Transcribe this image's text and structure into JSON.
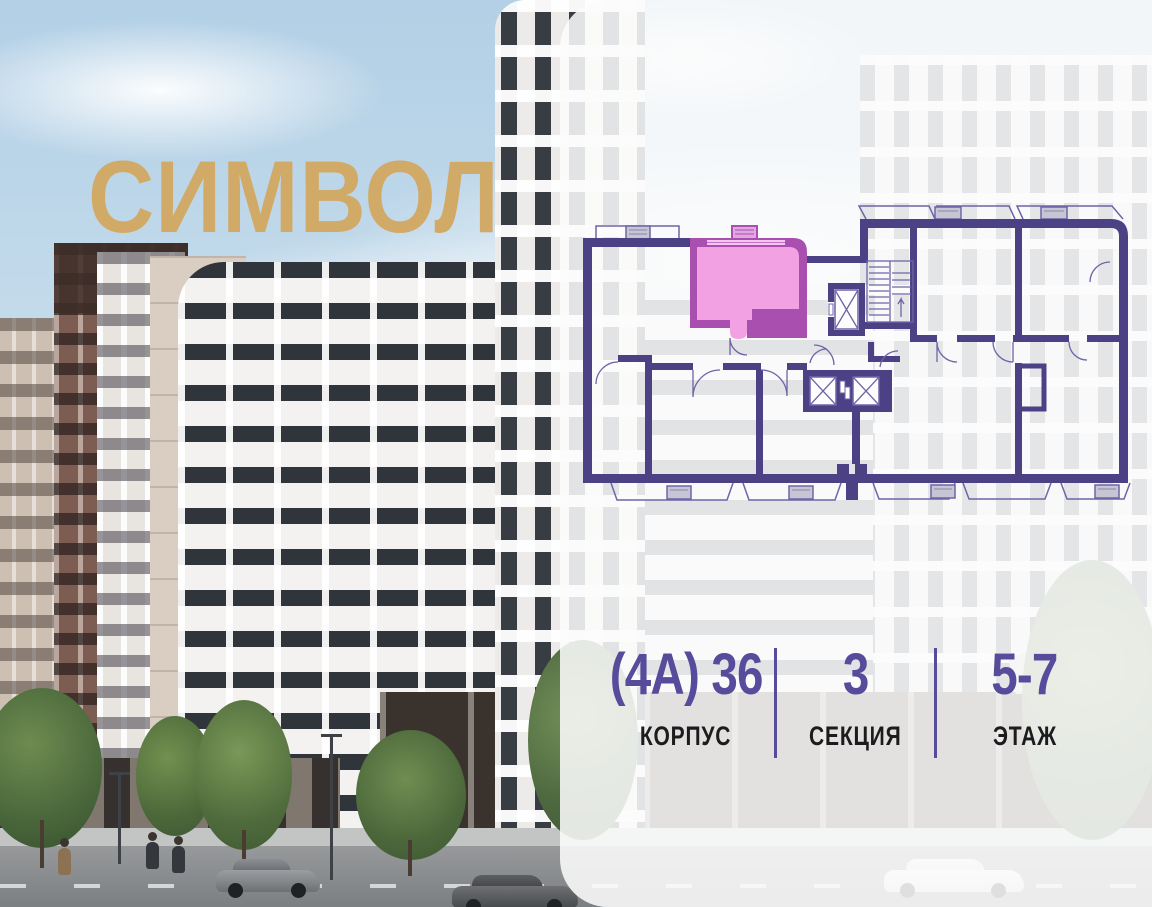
{
  "brand": {
    "logo": "СИМВОЛ"
  },
  "apartment_card": {
    "columns": [
      {
        "value": "(4А) 36",
        "label": "КОРПУС"
      },
      {
        "value": "3",
        "label": "СЕКЦИЯ"
      },
      {
        "value": "5-7",
        "label": "ЭТАЖ"
      }
    ]
  },
  "colors": {
    "logo-gold": "#d2aa68",
    "accent-purple": "#564c9b",
    "label-black": "#1c1c1e",
    "plan-wall": "#4c4185",
    "plan-thin": "#6e64a8",
    "plan-window": "#8ed9f4",
    "unit-wall": "#a84fb0",
    "unit-fill": "#f2a2e2",
    "panel-bg": "rgba(251,251,252,0.87)"
  }
}
